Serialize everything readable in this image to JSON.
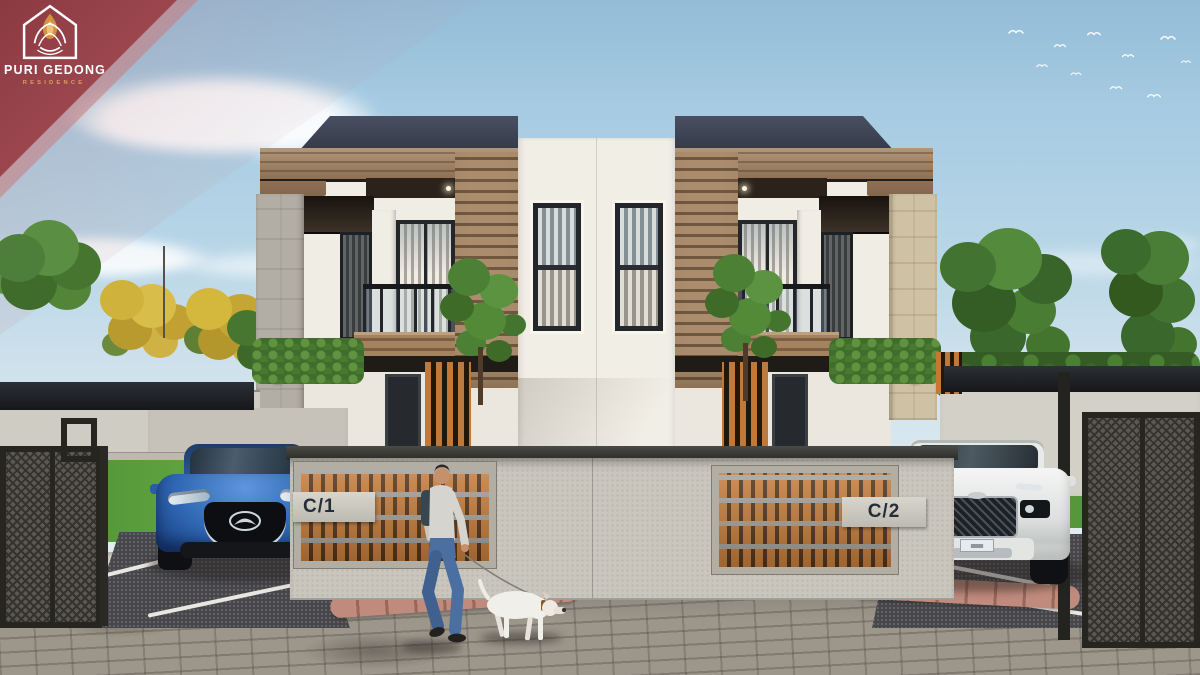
{
  "branding": {
    "name": "PURI GEDONG",
    "subtitle": "RESIDENCE"
  },
  "units": {
    "left_label": "C/1",
    "right_label": "C/2"
  },
  "colors": {
    "badge_maroon": "#9a4049",
    "brand_gold": "#d9a05c",
    "sky_blue": "#a6cbe2",
    "wood_accent": "#a5876a",
    "breezeblock_orange": "#c67d3c",
    "roof_dark": "#3c4250",
    "wall_gray": "#c9c6be",
    "car_left": "#2f67b4",
    "car_right": "#eef0ee"
  }
}
